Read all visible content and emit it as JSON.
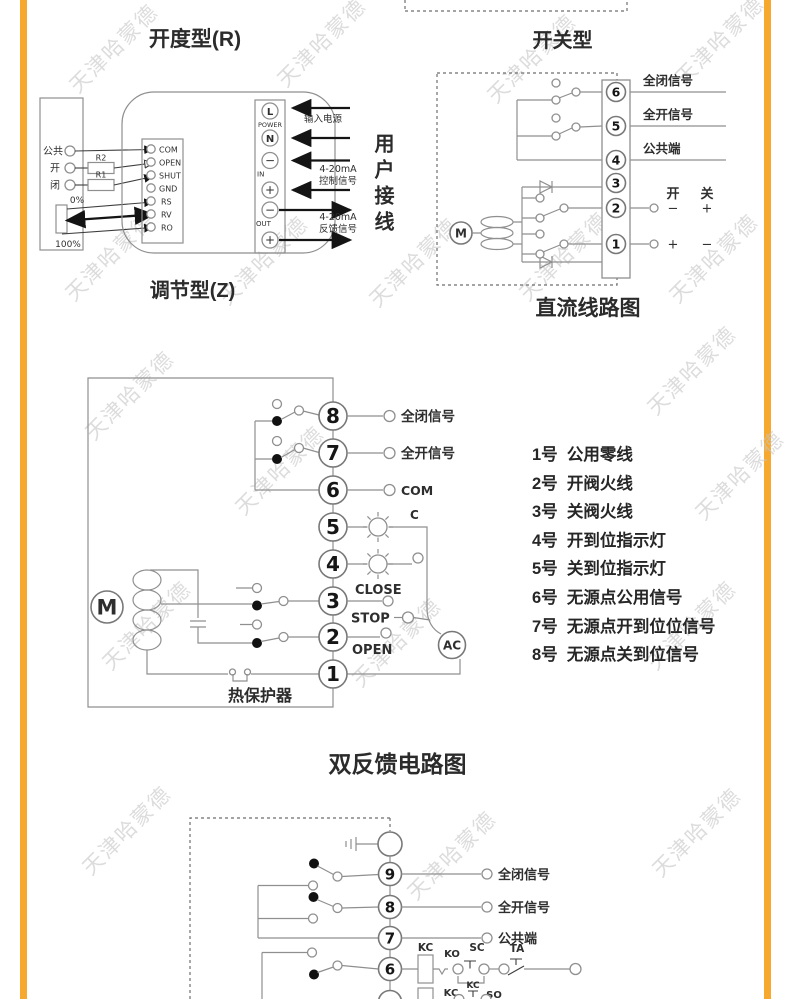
{
  "page": {
    "accent_orange": "#F7A82E"
  },
  "watermark": {
    "text": "天津哈蒙德"
  },
  "d1": {
    "title": "开度型(R)",
    "subtitle": "调节型(Z)",
    "left_terminals": [
      "公共",
      "开",
      "闭"
    ],
    "r2": "R2",
    "r1": "R1",
    "pot_top": "0%",
    "pot_bottom": "100%",
    "board_terminals": [
      "COM",
      "OPEN",
      "SHUT",
      "GND",
      "RS",
      "RV",
      "RO"
    ],
    "strip": {
      "l": "L",
      "power": "POWER",
      "n": "N",
      "minus_in": "−",
      "in": "IN",
      "plus_in": "+",
      "minus_out": "−",
      "out": "OUT",
      "plus_out": "+"
    },
    "labels": {
      "input_power": "输入电源",
      "ma1": "4-20mA",
      "ctrl": "控制信号",
      "ma2": "4-20mA",
      "feedback": "反馈信号",
      "user_wiring": "用户接线"
    }
  },
  "d2": {
    "title": "开关型",
    "caption": "直流线路图",
    "terminals": [
      "6",
      "5",
      "4",
      "3",
      "2",
      "1"
    ],
    "signal_closed": "全闭信号",
    "signal_open": "全开信号",
    "common": "公共端",
    "col_open": "开",
    "col_close": "关",
    "t2_left": "−",
    "t2_right": "+",
    "t1_left": "+",
    "t1_right": "−",
    "motor": "M"
  },
  "d3": {
    "caption": "双反馈电路图",
    "terminals": [
      "8",
      "7",
      "6",
      "5",
      "4",
      "3",
      "2",
      "1"
    ],
    "signal_closed": "全闭信号",
    "signal_open": "全开信号",
    "com": "COM",
    "c": "C",
    "close": "CLOSE",
    "stop": "STOP",
    "open": "OPEN",
    "ac": "AC",
    "motor": "M",
    "thermal": "热保护器",
    "legend": [
      "1号  公用零线",
      "2号  开阀火线",
      "3号  关阀火线",
      "4号  开到位指示灯",
      "5号  关到位指示灯",
      "6号  无源点公用信号",
      "7号  无源点开到位位信号",
      "8号  无源点关到位信号"
    ]
  },
  "d4": {
    "terminals": [
      "9",
      "8",
      "7",
      "6"
    ],
    "signal_closed": "全闭信号",
    "signal_open": "全开信号",
    "common": "公共端",
    "kc": "KC",
    "ko": "KO",
    "sc": "SC",
    "ta": "TA",
    "kc2": "KC",
    "kc3": "KC",
    "so": "SO"
  }
}
